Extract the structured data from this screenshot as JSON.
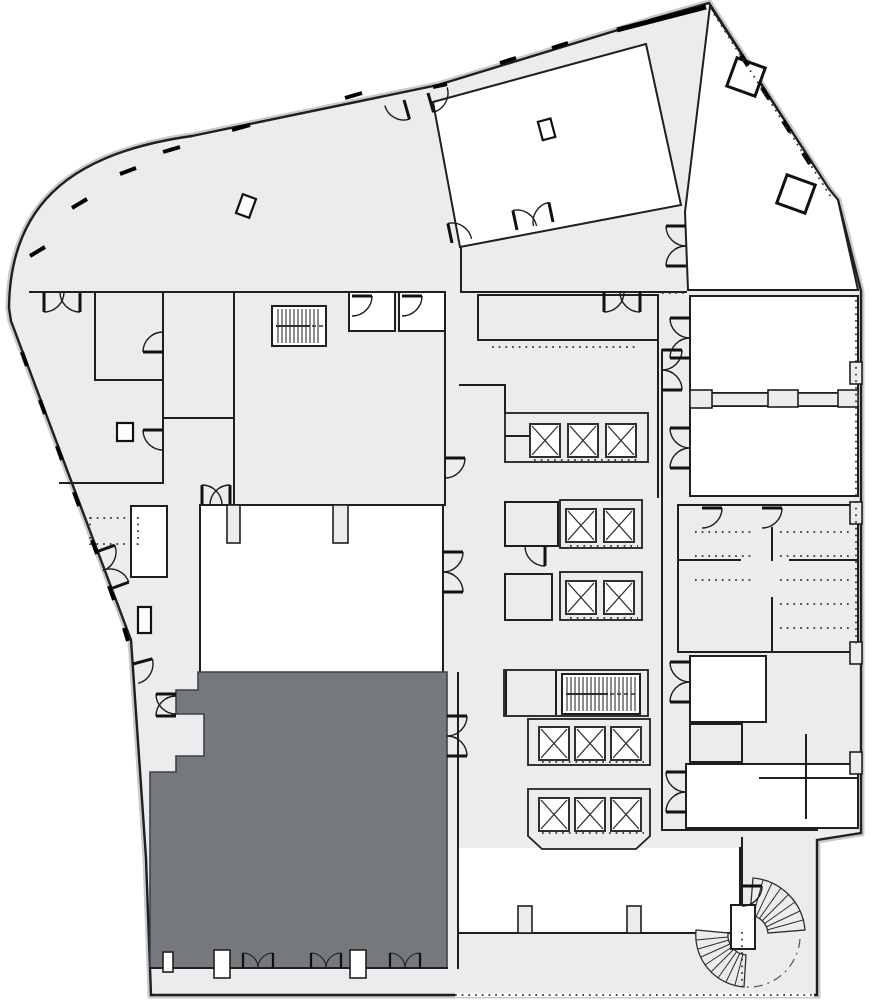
{
  "document": {
    "type": "architectural-floor-plan",
    "title": "Building floor plan",
    "visible_text": []
  },
  "colors": {
    "background": "#ffffff",
    "floor": "#ececee",
    "room_white": "#ffffff",
    "highlight": "#75797e",
    "wall": "#1f1f1f",
    "wall_shadow": "#c7cacc",
    "detail": "#2f2f2f"
  },
  "plan": {
    "regions": [
      {
        "name": "curved-lounge",
        "fill_key": "floor"
      },
      {
        "name": "banquet-room",
        "fill_key": "room_white"
      },
      {
        "name": "upper-right-room",
        "fill_key": "room_white"
      },
      {
        "name": "meeting-room-a",
        "fill_key": "room_white"
      },
      {
        "name": "meeting-room-b",
        "fill_key": "room_white"
      },
      {
        "name": "service-pantry",
        "fill_key": "floor"
      },
      {
        "name": "central-hall",
        "fill_key": "floor"
      },
      {
        "name": "ballroom",
        "fill_key": "room_white"
      },
      {
        "name": "highlighted-suite",
        "fill_key": "highlight",
        "highlighted": true
      },
      {
        "name": "lobby",
        "fill_key": "room_white"
      },
      {
        "name": "restrooms",
        "fill_key": "floor"
      },
      {
        "name": "coat-room",
        "fill_key": "room_white"
      },
      {
        "name": "spiral-stair-room",
        "fill_key": "floor"
      }
    ],
    "symbols": {
      "elevator_banks": 5,
      "elevator_cars": 13,
      "straight_stair_flights": 2,
      "spiral_stairs": 1,
      "door_swings": 47,
      "columns": 6,
      "pilasters": 11
    }
  }
}
